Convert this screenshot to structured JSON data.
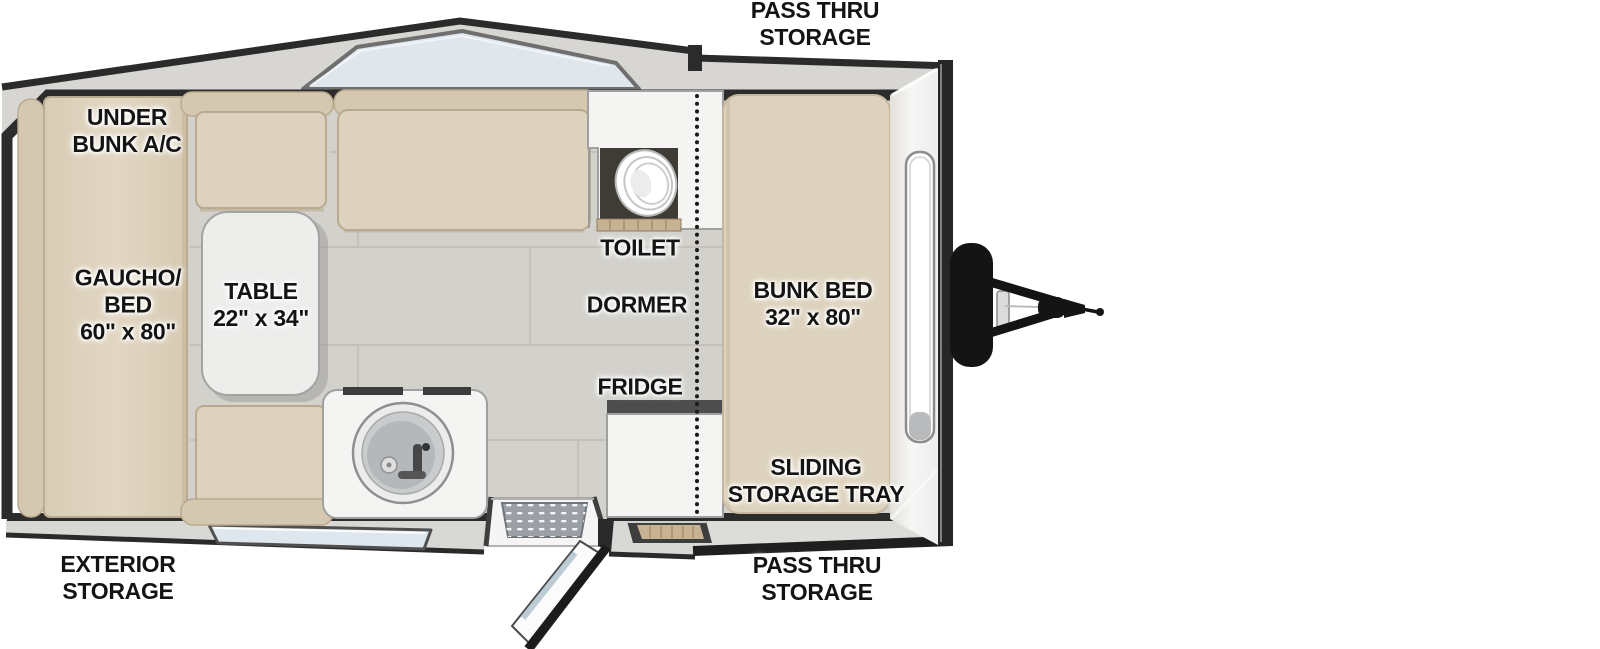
{
  "theme": {
    "background": "#ffffff",
    "cushion": "#ddd2bd",
    "bolster": "#d5c8b1",
    "cushion_edge": "#b9aa8f",
    "floor": "#d3d1cb",
    "tile_line": "#c3c1ba",
    "wall": "#2c2c2c",
    "roof": "#d7d6d2",
    "roof_edge": "#2b2b2b",
    "skylight": "#dfe7ed",
    "skylight_frame": "#6f6f6f",
    "cabinet": "#f4f4f3",
    "cabinet_edge": "#a0a0a0",
    "counter_dark": "#4d4d4d",
    "nook": "#3f3b35",
    "wood_trim": "#c7b393",
    "glass": "#dde7ed",
    "mat": "#9aa0a5",
    "hitch": "#141414",
    "label_color": "#141414"
  },
  "labels": {
    "pass_thru_top": {
      "lines": [
        "PASS THRU",
        "STORAGE"
      ]
    },
    "under_bunk_ac": {
      "lines": [
        "UNDER",
        "BUNK A/C"
      ]
    },
    "gaucho_bed": {
      "lines": [
        "GAUCHO/",
        "BED",
        "60\" x 80\""
      ]
    },
    "dinette_table": {
      "lines": [
        "TABLE",
        "22\" x 34\""
      ]
    },
    "toilet": {
      "lines": [
        "TOILET"
      ]
    },
    "dormer": {
      "lines": [
        "DORMER"
      ]
    },
    "fridge": {
      "lines": [
        "FRIDGE"
      ]
    },
    "bunk_bed": {
      "lines": [
        "BUNK BED",
        "32\" x 80\""
      ]
    },
    "sliding_storage_tray": {
      "lines": [
        "SLIDING",
        "STORAGE TRAY"
      ]
    },
    "exterior_storage": {
      "lines": [
        "EXTERIOR",
        "STORAGE"
      ]
    },
    "pass_thru_bottom": {
      "lines": [
        "PASS THRU",
        "STORAGE"
      ]
    }
  }
}
